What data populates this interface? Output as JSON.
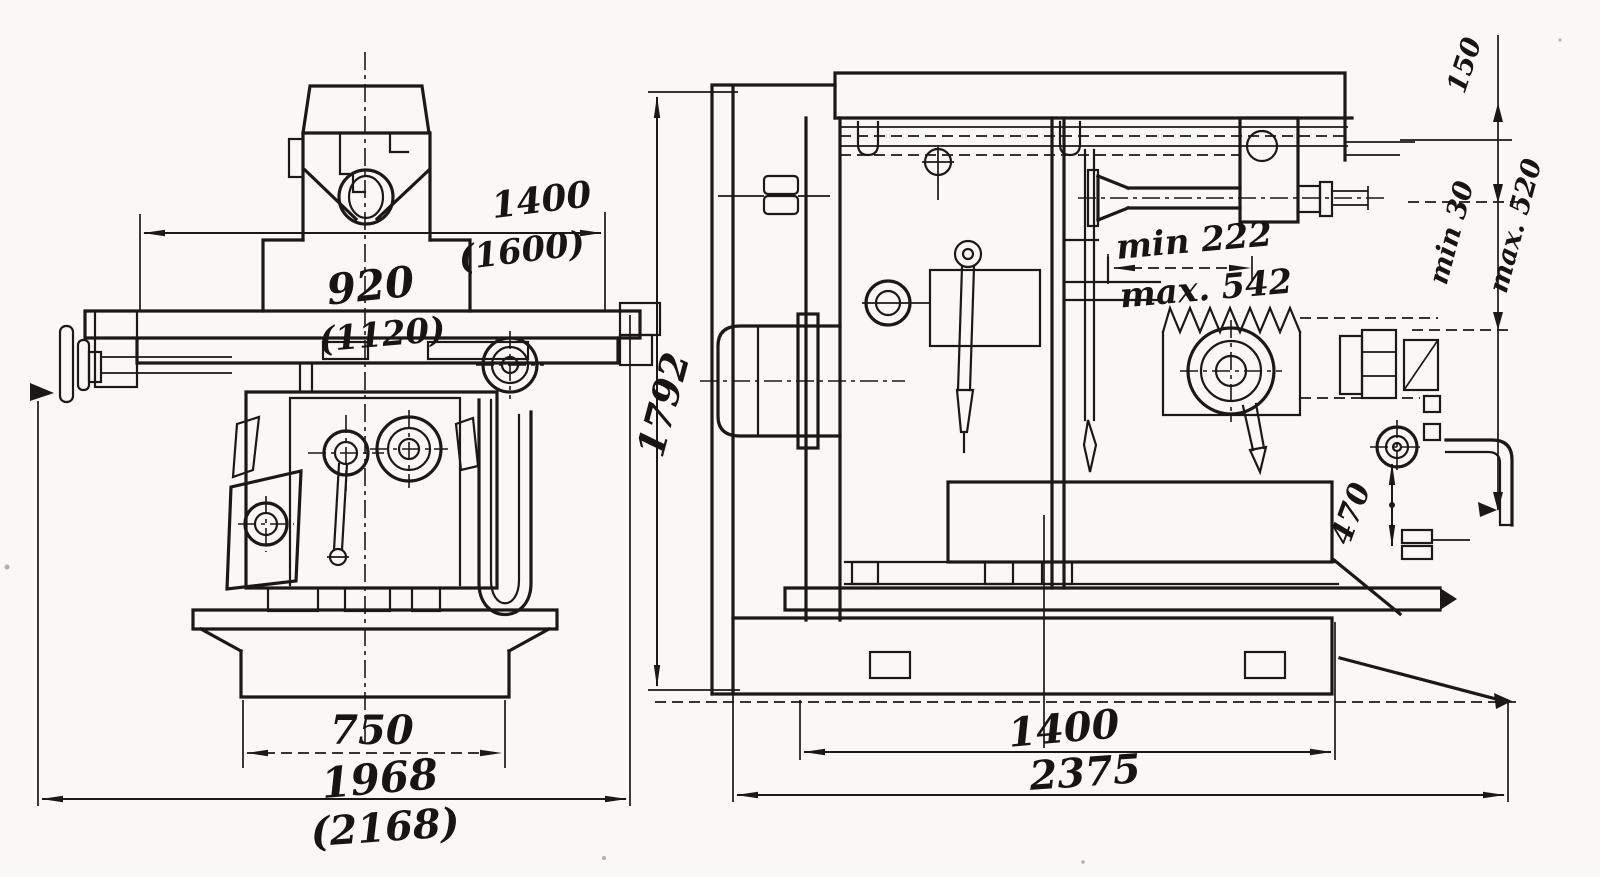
{
  "document": {
    "kind": "scanned machine-tool dimension drawing, two orthographic views",
    "ink_color": "#1b1916",
    "paper_color": "#f9f8f4"
  },
  "front_view": {
    "dims": {
      "overarm_width": "1400",
      "overarm_width_alt": "(1600)",
      "table_width": "920",
      "table_width_alt": "(1120)",
      "base_width": "750",
      "overall_width": "1968",
      "overall_width_alt": "(2168)"
    }
  },
  "side_view": {
    "dims": {
      "overall_height": "1792",
      "spindle_min": "min 222",
      "spindle_max": "max. 542",
      "top_offset": "150",
      "gap_min": "min 30",
      "gap_max": "max. 520",
      "tank_height": "470",
      "base_length": "1400",
      "overall_length": "2375"
    }
  }
}
